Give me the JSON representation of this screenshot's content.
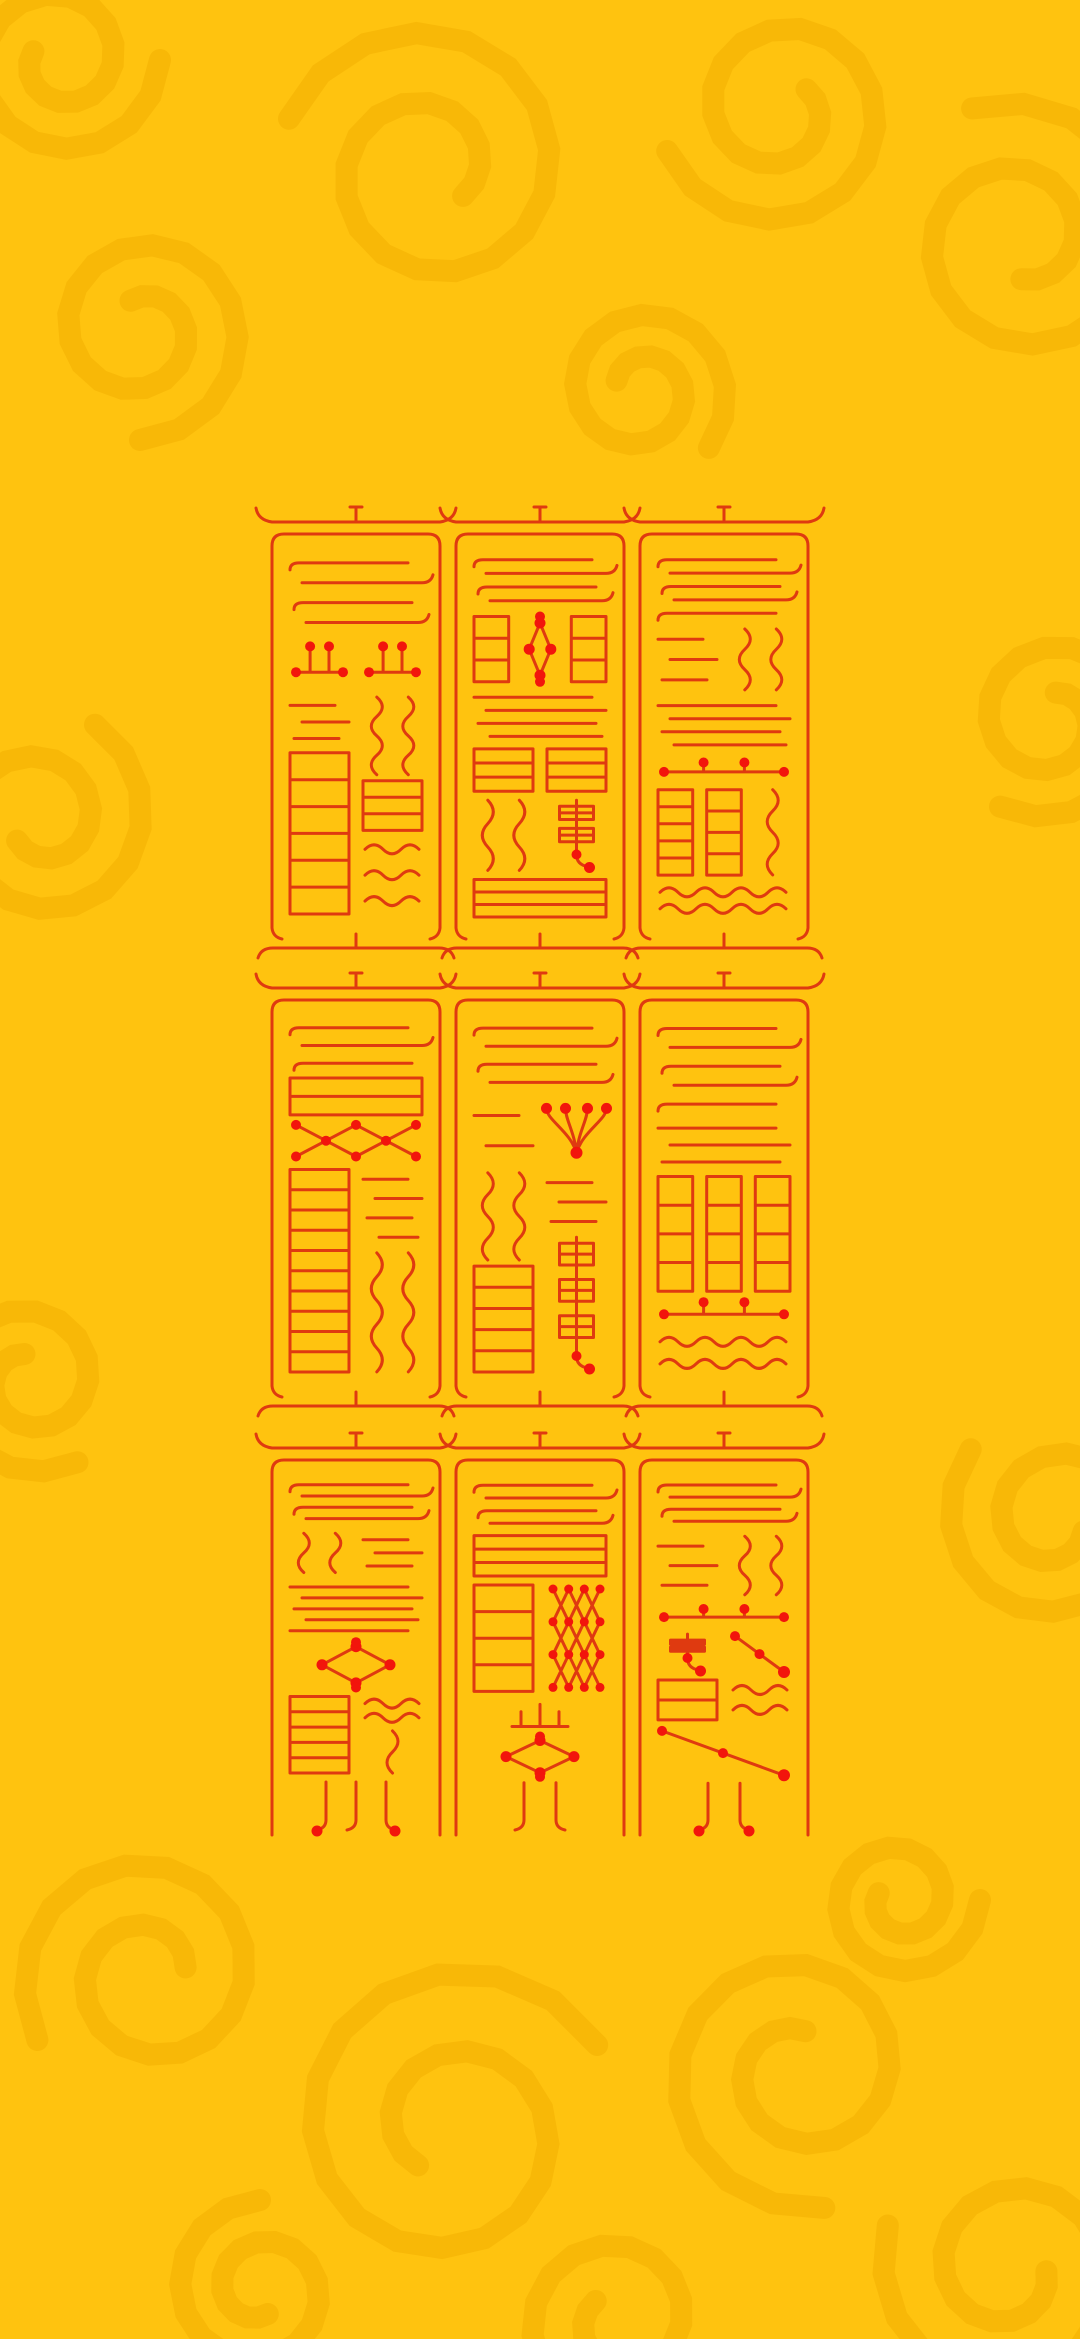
{
  "palette": {
    "background": "#FFC30F",
    "swirl": "#F1AE00",
    "swirl_opacity": 0.5,
    "stroke": "#DF3A10",
    "dot": "#F2150C",
    "stroke_width": 3
  },
  "canvas": {
    "width": 1080,
    "height": 2339
  },
  "grid": {
    "cols_x": [
      272,
      456,
      640
    ],
    "cell_w": 168,
    "rows": [
      {
        "y": 522,
        "h": 428,
        "closed": true
      },
      {
        "y": 988,
        "h": 420,
        "closed": true
      },
      {
        "y": 1448,
        "h": 387,
        "closed": false
      }
    ]
  },
  "swirls": [
    {
      "x": 430,
      "y": 170,
      "r": 150,
      "a": 200,
      "d": 1
    },
    {
      "x": 140,
      "y": 330,
      "r": 110,
      "a": 90,
      "d": -1
    },
    {
      "x": 60,
      "y": 60,
      "r": 100,
      "a": 0,
      "d": 1
    },
    {
      "x": 780,
      "y": 110,
      "r": 120,
      "a": 160,
      "d": -1
    },
    {
      "x": 1020,
      "y": 240,
      "r": 140,
      "a": 250,
      "d": 1
    },
    {
      "x": 640,
      "y": 390,
      "r": 90,
      "a": 40,
      "d": -1
    },
    {
      "x": 40,
      "y": 820,
      "r": 110,
      "a": 300,
      "d": 1
    },
    {
      "x": 1050,
      "y": 720,
      "r": 100,
      "a": 120,
      "d": -1
    },
    {
      "x": 30,
      "y": 1380,
      "r": 95,
      "a": 60,
      "d": 1
    },
    {
      "x": 1055,
      "y": 1520,
      "r": 110,
      "a": 220,
      "d": -1
    },
    {
      "x": 150,
      "y": 1975,
      "r": 130,
      "a": 150,
      "d": 1
    },
    {
      "x": 450,
      "y": 2130,
      "r": 170,
      "a": 330,
      "d": -1
    },
    {
      "x": 800,
      "y": 2070,
      "r": 140,
      "a": 80,
      "d": 1
    },
    {
      "x": 1010,
      "y": 2270,
      "r": 130,
      "a": 200,
      "d": -1
    },
    {
      "x": 620,
      "y": 2320,
      "r": 110,
      "a": 20,
      "d": 1
    },
    {
      "x": 260,
      "y": 2290,
      "r": 90,
      "a": 270,
      "d": -1
    },
    {
      "x": 900,
      "y": 1900,
      "r": 80,
      "a": 0,
      "d": 1
    }
  ],
  "talismans": [
    {
      "row": 0,
      "col": 0,
      "blocks": [
        {
          "t": "bars",
          "n": 4,
          "hook": 1,
          "w": 3
        },
        {
          "t": "split",
          "w": 10,
          "l": [
            {
              "t": "dotbar",
              "w": 2
            },
            {
              "t": "bars",
              "n": 3,
              "w": 2
            },
            {
              "t": "ladder",
              "n": 6,
              "w": 6
            }
          ],
          "r": [
            {
              "t": "dotbar",
              "w": 2
            },
            {
              "t": "squig",
              "cols": 2,
              "w": 3
            },
            {
              "t": "ladder",
              "n": 3,
              "w": 2
            },
            {
              "t": "wave",
              "n": 3,
              "w": 3
            }
          ]
        }
      ]
    },
    {
      "row": 0,
      "col": 1,
      "blocks": [
        {
          "t": "bars",
          "n": 4,
          "hook": 1,
          "w": 2.5
        },
        {
          "t": "split",
          "w": 3.2,
          "l": [
            {
              "t": "ladder",
              "n": 3,
              "w": 1
            }
          ],
          "c": [
            {
              "t": "diamond",
              "w": 1
            }
          ],
          "r": [
            {
              "t": "ladder",
              "n": 3,
              "w": 1
            }
          ]
        },
        {
          "t": "bars",
          "n": 4,
          "w": 2.4
        },
        {
          "t": "ladder",
          "cols": 2,
          "n": 3,
          "w": 2
        },
        {
          "t": "split",
          "w": 3.4,
          "l": [
            {
              "t": "squig",
              "cols": 2,
              "w": 1
            }
          ],
          "r": [
            {
              "t": "vdots",
              "n": 2,
              "w": 1
            }
          ]
        },
        {
          "t": "ladder",
          "n": 3,
          "w": 1.8
        }
      ]
    },
    {
      "row": 0,
      "col": 2,
      "blocks": [
        {
          "t": "bars",
          "n": 5,
          "hook": 1,
          "w": 3
        },
        {
          "t": "split",
          "w": 3,
          "l": [
            {
              "t": "bars",
              "n": 3,
              "w": 1
            }
          ],
          "r": [
            {
              "t": "squig",
              "cols": 2,
              "w": 1
            }
          ]
        },
        {
          "t": "bars",
          "n": 4,
          "w": 2.4
        },
        {
          "t": "dotbar",
          "w": 1.2
        },
        {
          "t": "split",
          "w": 4,
          "l": [
            {
              "t": "ladder",
              "n": 5,
              "w": 1
            }
          ],
          "c": [
            {
              "t": "ladder",
              "n": 4,
              "w": 1
            }
          ],
          "r": [
            {
              "t": "squig",
              "cols": 1,
              "w": 1
            }
          ]
        },
        {
          "t": "wave",
          "n": 2,
          "w": 1.6
        }
      ]
    },
    {
      "row": 1,
      "col": 0,
      "blocks": [
        {
          "t": "bars",
          "n": 3,
          "hook": 1,
          "w": 2.2
        },
        {
          "t": "ladder",
          "n": 2,
          "w": 1.6
        },
        {
          "t": "xband",
          "w": 1.7
        },
        {
          "t": "split",
          "w": 8,
          "l": [
            {
              "t": "ladder",
              "n": 10,
              "w": 1
            }
          ],
          "r": [
            {
              "t": "bars",
              "n": 4,
              "w": 2
            },
            {
              "t": "squig",
              "cols": 2,
              "w": 3
            }
          ]
        }
      ]
    },
    {
      "row": 1,
      "col": 1,
      "blocks": [
        {
          "t": "bars",
          "n": 4,
          "hook": 1,
          "w": 2.6
        },
        {
          "t": "split",
          "w": 2.4,
          "l": [
            {
              "t": "bars",
              "n": 2,
              "w": 1
            }
          ],
          "r": [
            {
              "t": "trident",
              "w": 1
            }
          ]
        },
        {
          "t": "split",
          "w": 7,
          "l": [
            {
              "t": "squig",
              "cols": 2,
              "w": 2.5
            },
            {
              "t": "ladder",
              "n": 5,
              "w": 3
            }
          ],
          "r": [
            {
              "t": "bars",
              "n": 3,
              "w": 1.6
            },
            {
              "t": "vdots",
              "n": 3,
              "w": 3.5
            }
          ]
        }
      ]
    },
    {
      "row": 1,
      "col": 2,
      "blocks": [
        {
          "t": "bars",
          "n": 5,
          "hook": 1,
          "w": 3
        },
        {
          "t": "bars",
          "n": 3,
          "w": 1.7
        },
        {
          "t": "ladder",
          "cols": 3,
          "n": 4,
          "w": 3.6
        },
        {
          "t": "dotbar",
          "w": 1
        },
        {
          "t": "wave",
          "n": 2,
          "w": 1.5
        }
      ]
    },
    {
      "row": 2,
      "col": 0,
      "blocks": [
        {
          "t": "bars",
          "n": 4,
          "hook": 1,
          "w": 2.2
        },
        {
          "t": "split",
          "w": 2.2,
          "l": [
            {
              "t": "squig",
              "cols": 2,
              "w": 1
            }
          ],
          "r": [
            {
              "t": "bars",
              "n": 3,
              "w": 1
            }
          ]
        },
        {
          "t": "bars",
          "n": 5,
          "w": 2.6
        },
        {
          "t": "diamond",
          "w": 2.2
        },
        {
          "t": "split",
          "w": 3.8,
          "l": [
            {
              "t": "ladder",
              "n": 5,
              "w": 1
            }
          ],
          "r": [
            {
              "t": "wave",
              "n": 2,
              "w": 1
            },
            {
              "t": "squig",
              "cols": 1,
              "w": 1.4
            }
          ]
        },
        {
          "t": "tails",
          "n": 3,
          "dots": 1,
          "w": 1.8
        }
      ]
    },
    {
      "row": 2,
      "col": 1,
      "blocks": [
        {
          "t": "bars",
          "n": 4,
          "hook": 1,
          "w": 2.2
        },
        {
          "t": "ladder",
          "n": 3,
          "w": 1.8
        },
        {
          "t": "split",
          "w": 4.6,
          "l": [
            {
              "t": "ladder",
              "n": 4,
              "w": 1
            }
          ],
          "r": [
            {
              "t": "lattice",
              "nx": 4,
              "ny": 4,
              "w": 1
            }
          ]
        },
        {
          "t": "mount",
          "w": 1.4
        },
        {
          "t": "diamond",
          "w": 1.8
        },
        {
          "t": "tails",
          "n": 2,
          "w": 1.6
        }
      ]
    },
    {
      "row": 2,
      "col": 2,
      "blocks": [
        {
          "t": "bars",
          "n": 4,
          "hook": 1,
          "w": 2
        },
        {
          "t": "split",
          "w": 2.6,
          "l": [
            {
              "t": "bars",
              "n": 3,
              "w": 1
            }
          ],
          "r": [
            {
              "t": "squig",
              "cols": 2,
              "w": 1
            }
          ]
        },
        {
          "t": "dotbar",
          "w": 1
        },
        {
          "t": "split",
          "w": 3.6,
          "l": [
            {
              "t": "vdots",
              "n": 2,
              "w": 1
            },
            {
              "t": "ladder",
              "n": 2,
              "w": 1
            }
          ],
          "r": [
            {
              "t": "xdiag",
              "w": 1
            },
            {
              "t": "wave",
              "n": 2,
              "w": 1
            }
          ]
        },
        {
          "t": "xdiag",
          "w": 2
        },
        {
          "t": "tails",
          "n": 2,
          "dots": 1,
          "w": 1.5
        }
      ]
    }
  ]
}
